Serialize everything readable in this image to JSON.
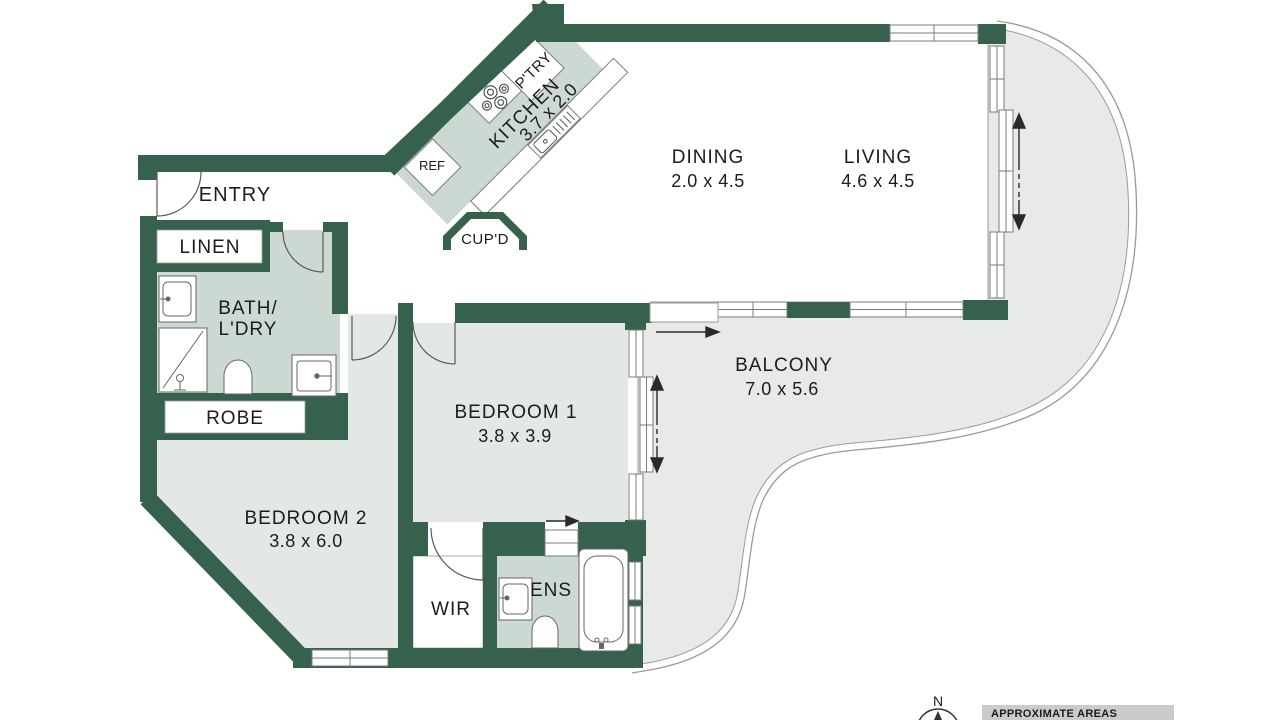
{
  "title": "Apartment floor plan",
  "rooms": {
    "entry": {
      "label": "ENTRY"
    },
    "linen": {
      "label": "LINEN"
    },
    "bath": {
      "label_line1": "BATH/",
      "label_line2": "L'DRY"
    },
    "robe": {
      "label": "ROBE"
    },
    "bedroom2": {
      "label": "BEDROOM 2",
      "dims": "3.8 x 6.0"
    },
    "bedroom1": {
      "label": "BEDROOM 1",
      "dims": "3.8 x 3.9"
    },
    "wir": {
      "label": "WIR"
    },
    "ens": {
      "label": "ENS"
    },
    "kitchen": {
      "label": "KITCHEN",
      "dims": "3.7 x 2.0"
    },
    "pantry": {
      "label": "P'TRY"
    },
    "ref": {
      "label": "REF"
    },
    "cupboard": {
      "label": "CUP'D"
    },
    "dining": {
      "label": "DINING",
      "dims": "2.0 x 4.5"
    },
    "living": {
      "label": "LIVING",
      "dims": "4.6 x 4.5"
    },
    "balcony": {
      "label": "BALCONY",
      "dims": "7.0 x 5.6"
    }
  },
  "compass": {
    "north_label": "N"
  },
  "footer": {
    "approximate_areas_label": "APPROXIMATE AREAS"
  },
  "colors": {
    "wall": "#35614d",
    "wet_area_floor": "#ccd8d2",
    "bedroom_floor": "#e3e7e5",
    "balcony_floor": "#e8eae8",
    "outline": "#8a8a8a",
    "areas_box_bg": "#cbcbcb"
  }
}
